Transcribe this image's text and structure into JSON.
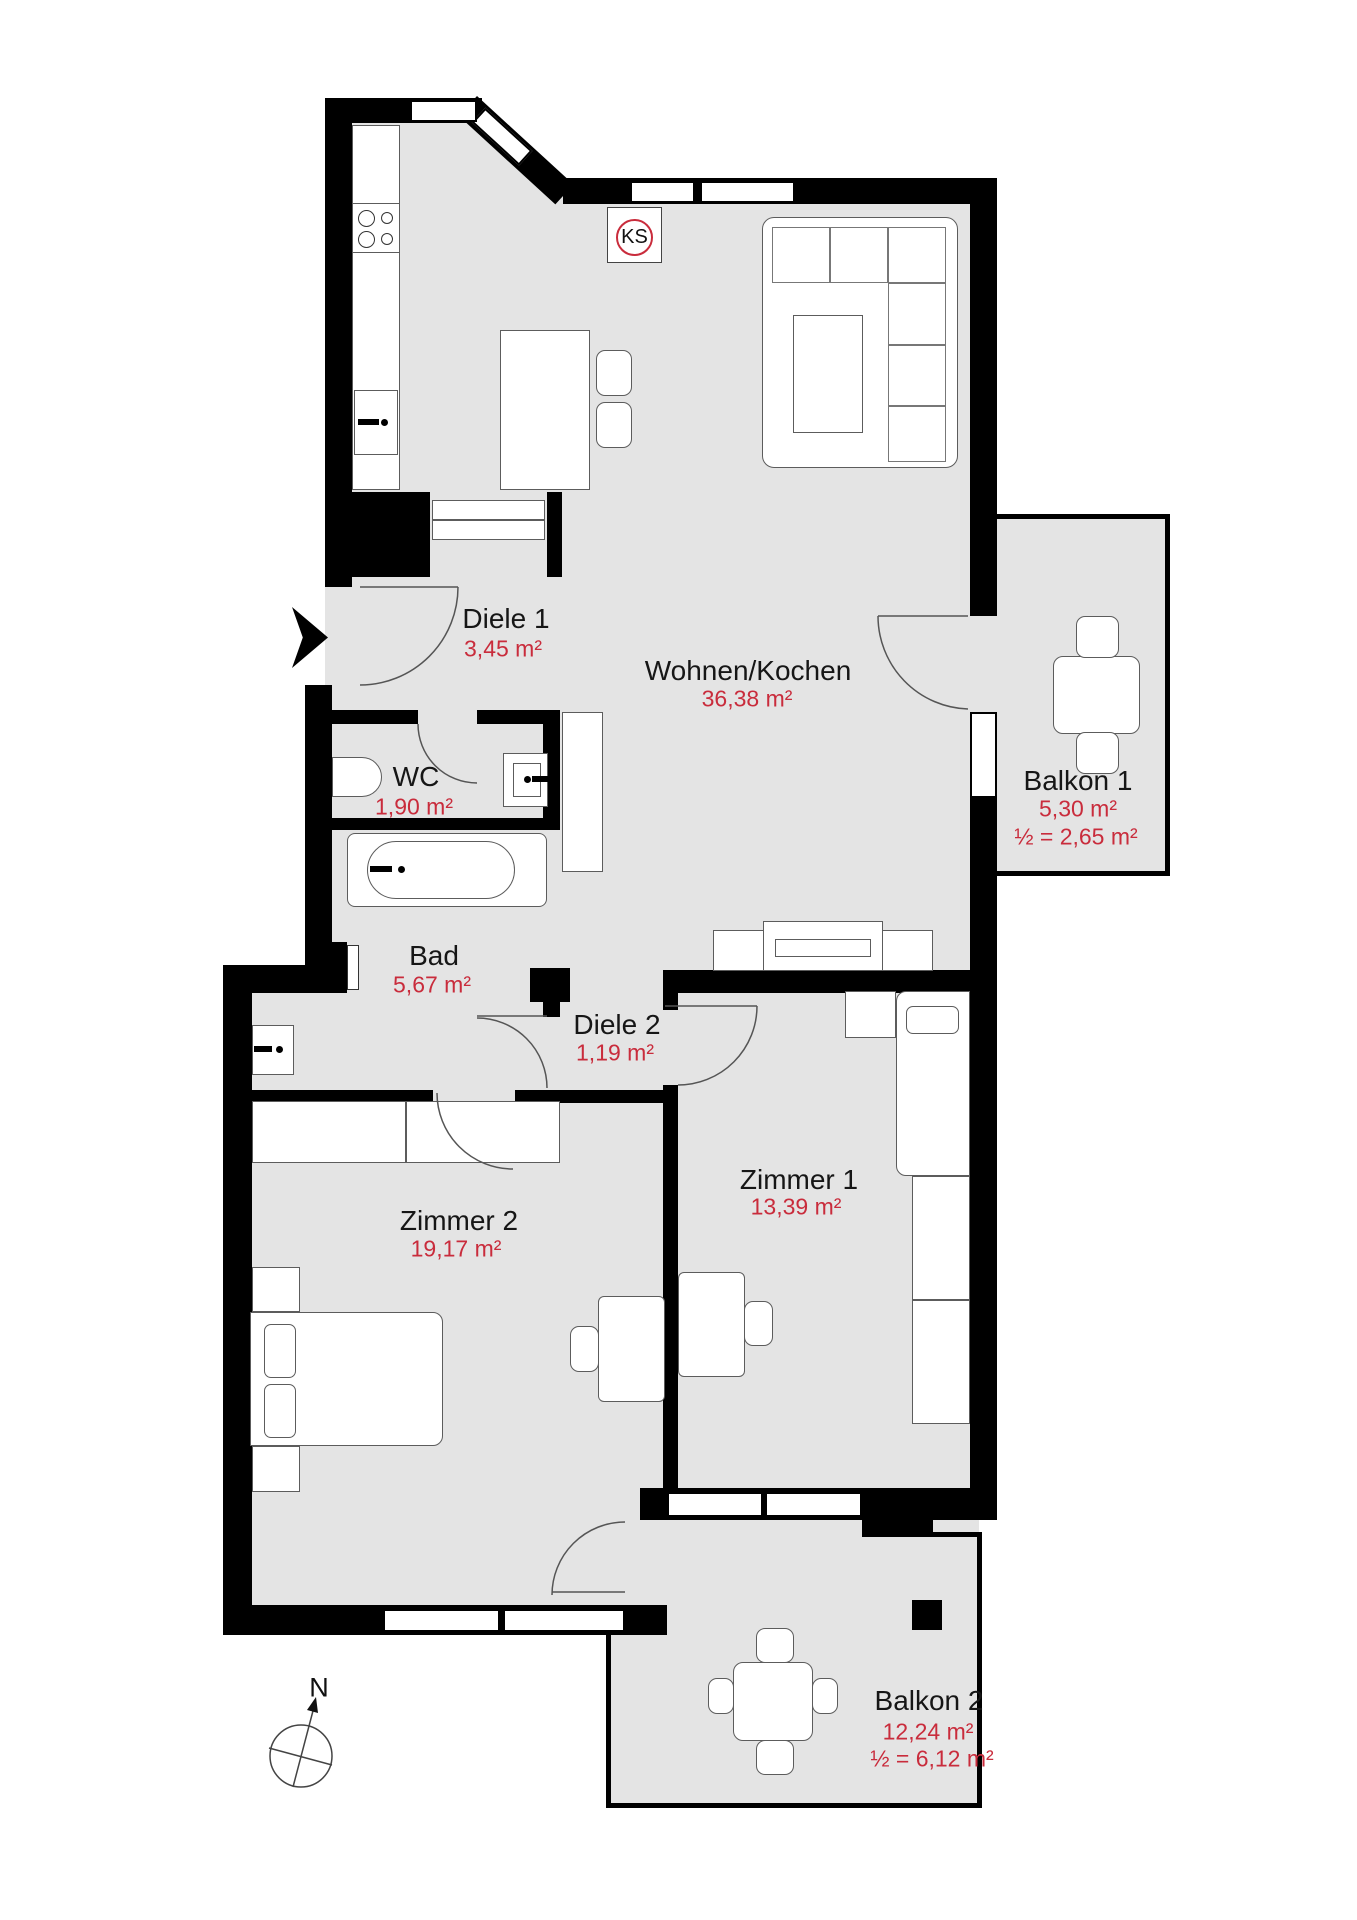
{
  "plan": {
    "rooms": {
      "diele1": {
        "name": "Diele 1",
        "area": "3,45 m²"
      },
      "wohnen": {
        "name": "Wohnen/Kochen",
        "area": "36,38 m²"
      },
      "wc": {
        "name": "WC",
        "area": "1,90 m²"
      },
      "bad": {
        "name": "Bad",
        "area": "5,67 m²"
      },
      "diele2": {
        "name": "Diele 2",
        "area": "1,19 m²"
      },
      "zimmer1": {
        "name": "Zimmer 1",
        "area": "13,39 m²"
      },
      "zimmer2": {
        "name": "Zimmer 2",
        "area": "19,17 m²"
      },
      "balkon1": {
        "name": "Balkon 1",
        "area": "5,30 m²",
        "half_area": "½ = 2,65 m²"
      },
      "balkon2": {
        "name": "Balkon 2",
        "area": "12,24 m²",
        "half_area": "½ = 6,12 m²"
      }
    },
    "markers": {
      "fridge_label": "KS",
      "compass_label": "N"
    },
    "colors": {
      "area_text": "#c92c3c",
      "floor": "#e4e4e4",
      "wall": "#000000"
    }
  }
}
